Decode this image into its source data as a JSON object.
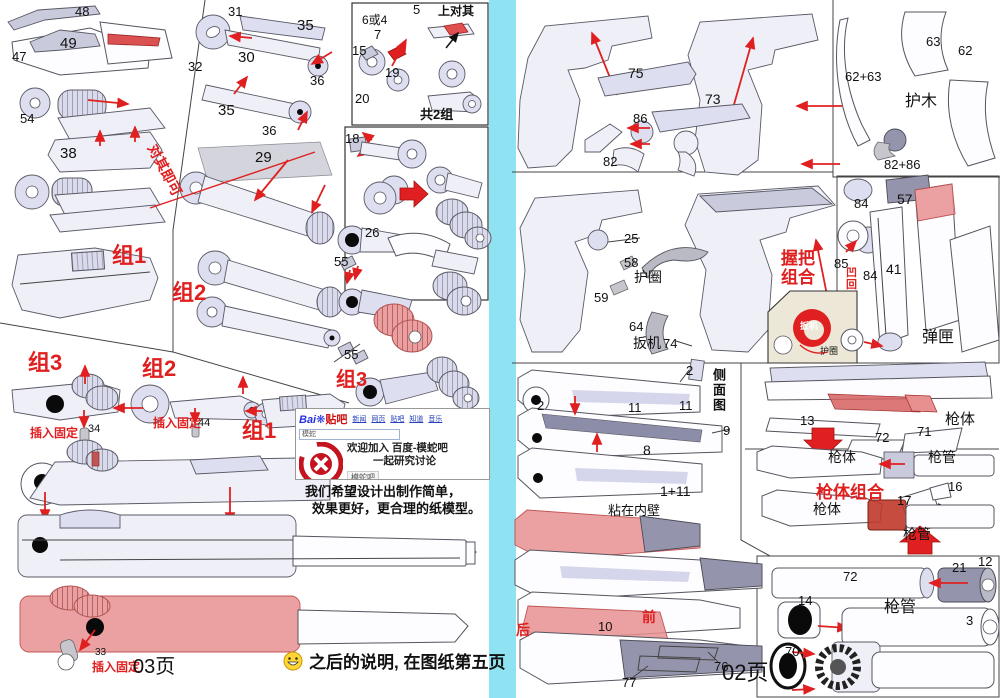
{
  "colors": {
    "divider_cyan": "#8FE2F1",
    "accent_red": "#E02020",
    "part_fill": "#EFEFF8",
    "part_dark": "#9495AC",
    "red_overlay": "#E89090"
  },
  "left_page": {
    "page_number": "03页",
    "footer_note": "之后的说明, 在图纸第五页",
    "caption_line1": "我们希望设计出制作简单，",
    "caption_line2": "效果更好，更合理的纸模型。",
    "labels": [
      {
        "t": "48",
        "x": 75,
        "y": 5
      },
      {
        "t": "47",
        "x": 12,
        "y": 50
      },
      {
        "t": "49",
        "x": 60,
        "y": 36,
        "s": 15
      },
      {
        "t": "54",
        "x": 20,
        "y": 112
      },
      {
        "t": "38",
        "x": 60,
        "y": 146,
        "s": 15
      },
      {
        "t": "31",
        "x": 228,
        "y": 5
      },
      {
        "t": "32",
        "x": 188,
        "y": 60
      },
      {
        "t": "30",
        "x": 238,
        "y": 50,
        "s": 15
      },
      {
        "t": "35",
        "x": 297,
        "y": 18,
        "s": 15
      },
      {
        "t": "36",
        "x": 310,
        "y": 74
      },
      {
        "t": "35",
        "x": 218,
        "y": 103,
        "s": 15
      },
      {
        "t": "36",
        "x": 262,
        "y": 124
      },
      {
        "t": "29",
        "x": 255,
        "y": 150,
        "s": 15
      },
      {
        "t": "对其即可",
        "x": 158,
        "y": 142,
        "c": "r",
        "s": 14,
        "b": 1,
        "rot": 62
      },
      {
        "t": "组1",
        "x": 112,
        "y": 245,
        "c": "r",
        "s": 22,
        "b": 1
      },
      {
        "t": "组2",
        "x": 172,
        "y": 282,
        "c": "r",
        "s": 22,
        "b": 1
      },
      {
        "t": "组3",
        "x": 28,
        "y": 352,
        "c": "r",
        "s": 22,
        "b": 1
      },
      {
        "t": "组2",
        "x": 142,
        "y": 358,
        "c": "r",
        "s": 22,
        "b": 1
      },
      {
        "t": "组1",
        "x": 242,
        "y": 420,
        "c": "r",
        "s": 22,
        "b": 1
      },
      {
        "t": "插入固定",
        "x": 30,
        "y": 427,
        "c": "r",
        "s": 12,
        "b": 1
      },
      {
        "t": "34",
        "x": 88,
        "y": 424,
        "s": 11
      },
      {
        "t": "插入固定",
        "x": 153,
        "y": 417,
        "c": "r",
        "s": 12,
        "b": 1
      },
      {
        "t": "44",
        "x": 198,
        "y": 418,
        "s": 11
      },
      {
        "t": "6或4",
        "x": 362,
        "y": 14,
        "s": 12
      },
      {
        "t": "5",
        "x": 413,
        "y": 3
      },
      {
        "t": "上对其",
        "x": 438,
        "y": 5,
        "s": 12,
        "b": 1
      },
      {
        "t": "7",
        "x": 374,
        "y": 28
      },
      {
        "t": "15",
        "x": 352,
        "y": 44
      },
      {
        "t": "19",
        "x": 385,
        "y": 66
      },
      {
        "t": "20",
        "x": 355,
        "y": 92
      },
      {
        "t": "共2组",
        "x": 420,
        "y": 108,
        "s": 13,
        "b": 1
      },
      {
        "t": "18",
        "x": 345,
        "y": 132
      },
      {
        "t": "26",
        "x": 365,
        "y": 226
      },
      {
        "t": "55",
        "x": 334,
        "y": 255
      },
      {
        "t": "55",
        "x": 344,
        "y": 348
      },
      {
        "t": "组3",
        "x": 336,
        "y": 370,
        "c": "r",
        "s": 20,
        "b": 1
      },
      {
        "t": "33",
        "x": 95,
        "y": 648,
        "s": 10
      },
      {
        "t": "插入固定",
        "x": 92,
        "y": 661,
        "c": "r",
        "s": 12,
        "b": 1
      }
    ]
  },
  "ad": {
    "logo_prefix": "Bai",
    "logo_suffix": "贴吧",
    "nav_items": [
      "新闻",
      "网页",
      "贴吧",
      "知道",
      "音乐"
    ],
    "search_value": "模蛇",
    "welcome_line1": "欢迎加入 百度-模蛇吧",
    "welcome_line2": "一起研究讨论",
    "forum_button": "模蛇吧",
    "badge_caption": "模蛇纸模吧"
  },
  "right_page": {
    "page_number": "02页",
    "labels": [
      {
        "t": "75",
        "x": 628,
        "y": 66,
        "s": 14
      },
      {
        "t": "73",
        "x": 705,
        "y": 92,
        "s": 14
      },
      {
        "t": "86",
        "x": 633,
        "y": 112
      },
      {
        "t": "82",
        "x": 603,
        "y": 155
      },
      {
        "t": "63",
        "x": 926,
        "y": 35
      },
      {
        "t": "62",
        "x": 958,
        "y": 44
      },
      {
        "t": "62+63",
        "x": 845,
        "y": 70
      },
      {
        "t": "护木",
        "x": 905,
        "y": 94,
        "s": 16
      },
      {
        "t": "82+86",
        "x": 884,
        "y": 158
      },
      {
        "t": "25",
        "x": 624,
        "y": 232
      },
      {
        "t": "58",
        "x": 624,
        "y": 256
      },
      {
        "t": "护圈",
        "x": 634,
        "y": 270,
        "s": 14
      },
      {
        "t": "59",
        "x": 594,
        "y": 291
      },
      {
        "t": "64",
        "x": 629,
        "y": 320
      },
      {
        "t": "扳机",
        "x": 633,
        "y": 336,
        "s": 14
      },
      {
        "t": "74",
        "x": 663,
        "y": 337
      },
      {
        "t": "握把",
        "x": 781,
        "y": 250,
        "c": "r",
        "s": 17,
        "b": 1
      },
      {
        "t": "组合",
        "x": 781,
        "y": 269,
        "c": "r",
        "s": 17,
        "b": 1
      },
      {
        "t": "扳机",
        "x": 800,
        "y": 322,
        "c": "w",
        "s": 9,
        "b": 1
      },
      {
        "t": "护圈",
        "x": 820,
        "y": 347,
        "s": 9
      },
      {
        "t": "84",
        "x": 854,
        "y": 197
      },
      {
        "t": "57",
        "x": 897,
        "y": 192,
        "s": 14
      },
      {
        "t": "85",
        "x": 834,
        "y": 257
      },
      {
        "t": "凹",
        "x": 846,
        "y": 268,
        "c": "r",
        "s": 11,
        "b": 1
      },
      {
        "t": "回",
        "x": 846,
        "y": 280,
        "c": "r",
        "s": 11,
        "b": 1
      },
      {
        "t": "84",
        "x": 863,
        "y": 269
      },
      {
        "t": "41",
        "x": 886,
        "y": 262,
        "s": 14
      },
      {
        "t": "弹匣",
        "x": 922,
        "y": 330,
        "s": 16
      },
      {
        "t": "2",
        "x": 537,
        "y": 399
      },
      {
        "t": "2",
        "x": 686,
        "y": 364
      },
      {
        "t": "11",
        "x": 628,
        "y": 401
      },
      {
        "t": "11",
        "x": 679,
        "y": 399
      },
      {
        "t": "侧面图",
        "x": 712,
        "y": 368,
        "s": 13,
        "b": 1,
        "v": 1
      },
      {
        "t": "9",
        "x": 723,
        "y": 424
      },
      {
        "t": "8",
        "x": 643,
        "y": 443,
        "s": 14
      },
      {
        "t": "1+11",
        "x": 660,
        "y": 484,
        "s": 14
      },
      {
        "t": "粘在内壁",
        "x": 608,
        "y": 504,
        "s": 13
      },
      {
        "t": "13",
        "x": 800,
        "y": 414
      },
      {
        "t": "72",
        "x": 875,
        "y": 431
      },
      {
        "t": "71",
        "x": 917,
        "y": 425
      },
      {
        "t": "枪体",
        "x": 945,
        "y": 412,
        "s": 15
      },
      {
        "t": "枪体",
        "x": 828,
        "y": 450,
        "s": 14
      },
      {
        "t": "枪管",
        "x": 928,
        "y": 450,
        "s": 14
      },
      {
        "t": "枪体组合",
        "x": 816,
        "y": 484,
        "c": "r",
        "s": 17,
        "b": 1
      },
      {
        "t": "17",
        "x": 897,
        "y": 494
      },
      {
        "t": "16",
        "x": 948,
        "y": 480
      },
      {
        "t": "枪体",
        "x": 813,
        "y": 502,
        "s": 14
      },
      {
        "t": "枪管",
        "x": 903,
        "y": 527,
        "s": 14
      },
      {
        "t": "72",
        "x": 843,
        "y": 570
      },
      {
        "t": "21",
        "x": 952,
        "y": 561
      },
      {
        "t": "12",
        "x": 978,
        "y": 555
      },
      {
        "t": "14",
        "x": 798,
        "y": 594
      },
      {
        "t": "枪管",
        "x": 884,
        "y": 600,
        "s": 16
      },
      {
        "t": "3",
        "x": 966,
        "y": 614
      },
      {
        "t": "70",
        "x": 785,
        "y": 645
      },
      {
        "t": "后",
        "x": 516,
        "y": 623,
        "c": "r",
        "s": 14,
        "b": 1
      },
      {
        "t": "10",
        "x": 598,
        "y": 620
      },
      {
        "t": "前",
        "x": 642,
        "y": 610,
        "c": "r",
        "s": 14,
        "b": 1
      },
      {
        "t": "76",
        "x": 714,
        "y": 660
      },
      {
        "t": "77",
        "x": 622,
        "y": 676
      }
    ]
  }
}
